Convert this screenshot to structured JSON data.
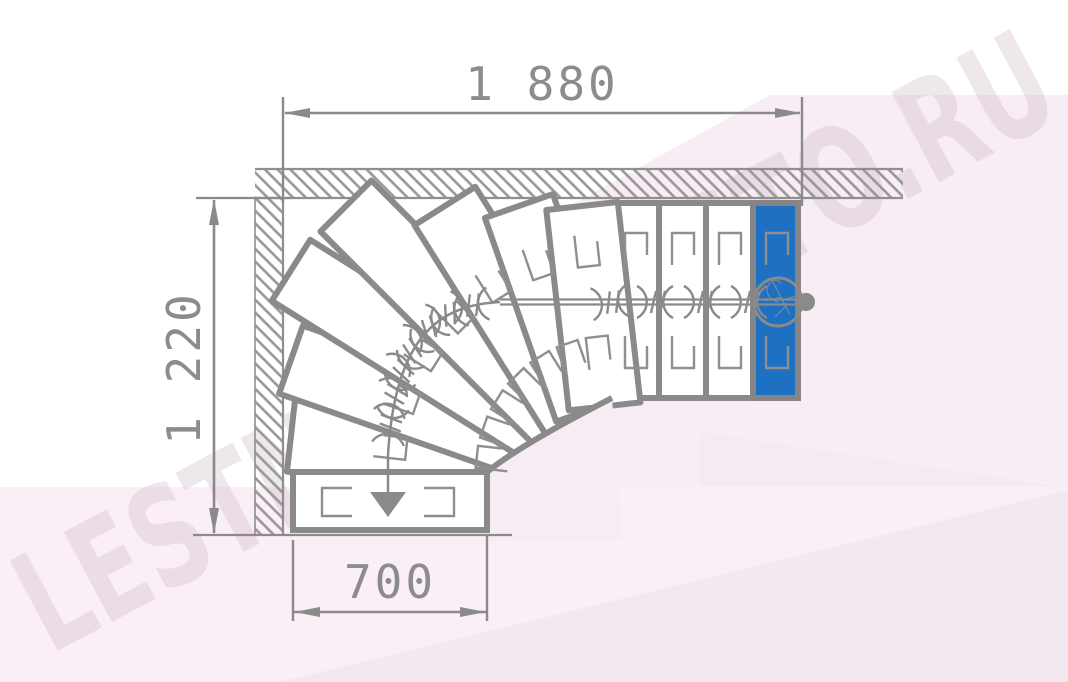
{
  "diagram": {
    "type": "staircase-floor-plan-quarter-turn-winder",
    "dimension_labels": {
      "top": "1 880",
      "left": "1 220",
      "bottom": "700"
    },
    "watermark_text": "LESTNICAPROSTO.RU",
    "steps": {
      "total": 12,
      "straight": 3,
      "winder": 7,
      "bottom_straight": 1,
      "highlighted_entry": 1
    },
    "colors": {
      "line": "#8a8a8a",
      "thin_line": "#8f8f8f",
      "hatch": "#979797",
      "highlight_step": "#1e70c3",
      "step_fill": "#ffffff",
      "pink_light": "#faeff6",
      "pink_mid": "#f8edf4",
      "pink_deep": "#f3e8ef",
      "pink_wedge": "#f5eaf1",
      "corner_patch": "#f7ecf3",
      "watermark": "#c9b2c1",
      "text": "#8c8c8c"
    },
    "icons": {
      "start": "walk-line-start-circle-icon",
      "end": "walk-line-down-arrow-icon"
    }
  }
}
